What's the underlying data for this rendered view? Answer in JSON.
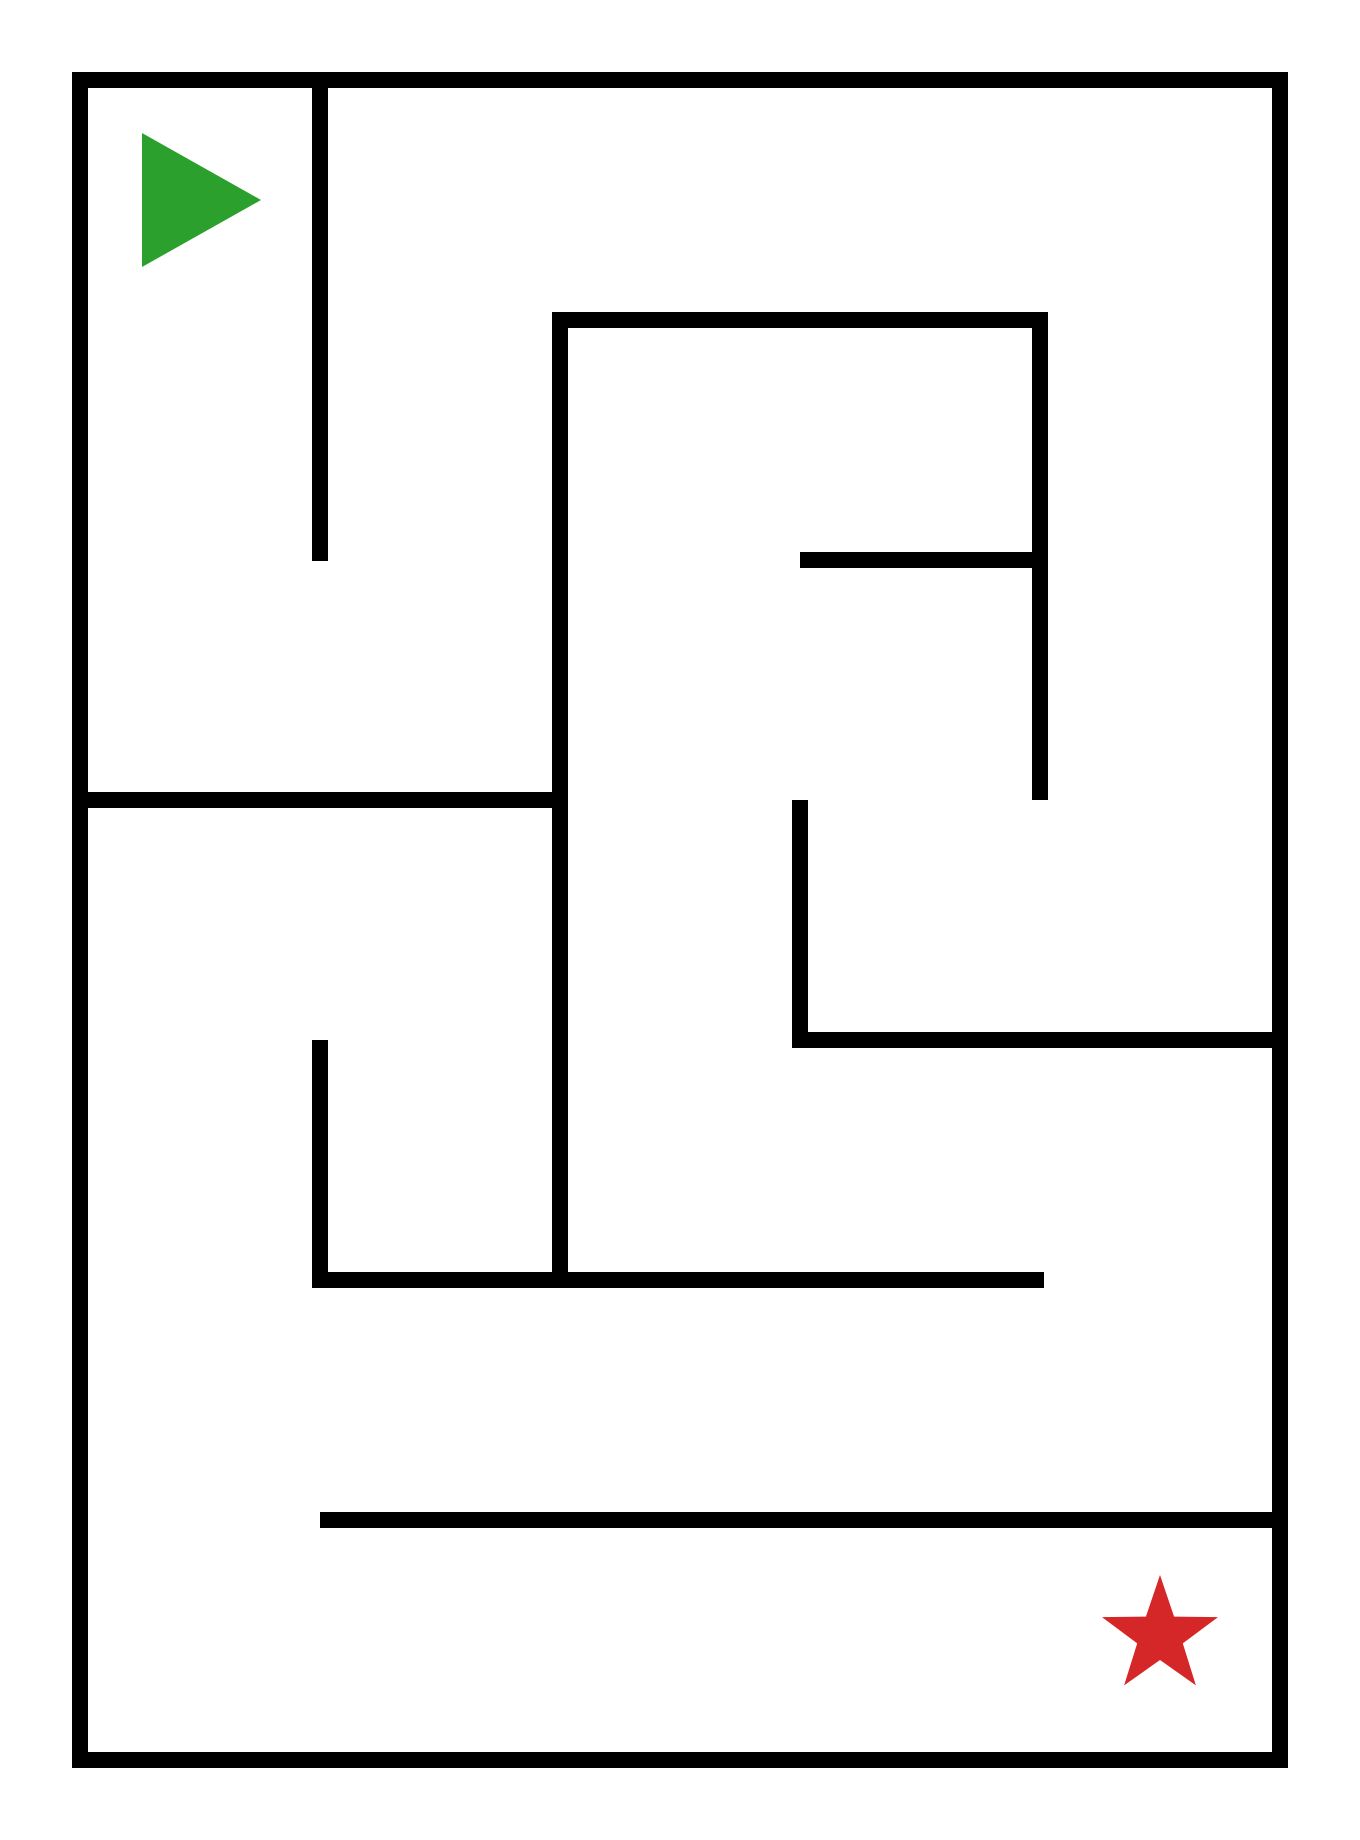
{
  "canvas": {
    "width": 1360,
    "height": 1840,
    "background": "#ffffff"
  },
  "maze": {
    "wall_color": "#000000",
    "wall_thickness": 16,
    "walls": [
      {
        "name": "border-top",
        "x": 72,
        "y": 72,
        "w": 1216,
        "h": 16
      },
      {
        "name": "border-bottom",
        "x": 72,
        "y": 1752,
        "w": 1216,
        "h": 16
      },
      {
        "name": "border-left",
        "x": 72,
        "y": 72,
        "w": 16,
        "h": 1696
      },
      {
        "name": "border-right",
        "x": 1272,
        "y": 72,
        "w": 16,
        "h": 1696
      },
      {
        "name": "wall-v-top-column",
        "x": 312,
        "y": 88,
        "w": 16,
        "h": 473
      },
      {
        "name": "wall-h-inner-box-top",
        "x": 552,
        "y": 312,
        "w": 496,
        "h": 16
      },
      {
        "name": "wall-v-inner-box-left",
        "x": 552,
        "y": 312,
        "w": 16,
        "h": 976
      },
      {
        "name": "wall-v-inner-box-right",
        "x": 1032,
        "y": 312,
        "w": 16,
        "h": 488
      },
      {
        "name": "wall-h-middle-bar",
        "x": 800,
        "y": 552,
        "w": 248,
        "h": 16
      },
      {
        "name": "wall-v-center",
        "x": 792,
        "y": 800,
        "w": 16,
        "h": 248
      },
      {
        "name": "wall-h-to-right-border",
        "x": 792,
        "y": 1032,
        "w": 496,
        "h": 16
      },
      {
        "name": "wall-h-left-room",
        "x": 88,
        "y": 792,
        "w": 480,
        "h": 16
      },
      {
        "name": "wall-v-bottom-left",
        "x": 312,
        "y": 1040,
        "w": 16,
        "h": 248
      },
      {
        "name": "wall-h-long-lower",
        "x": 312,
        "y": 1272,
        "w": 732,
        "h": 16
      },
      {
        "name": "wall-h-bottom-corridor",
        "x": 320,
        "y": 1512,
        "w": 968,
        "h": 16
      }
    ],
    "start_marker": {
      "shape": "triangle-right",
      "color": "#2ca02c",
      "points": [
        [
          142,
          133
        ],
        [
          142,
          267
        ],
        [
          261,
          200
        ]
      ]
    },
    "goal_marker": {
      "shape": "star-5",
      "color": "#d62728",
      "cx": 1160,
      "cy": 1636,
      "outer_radius": 61,
      "inner_radius": 24
    }
  }
}
